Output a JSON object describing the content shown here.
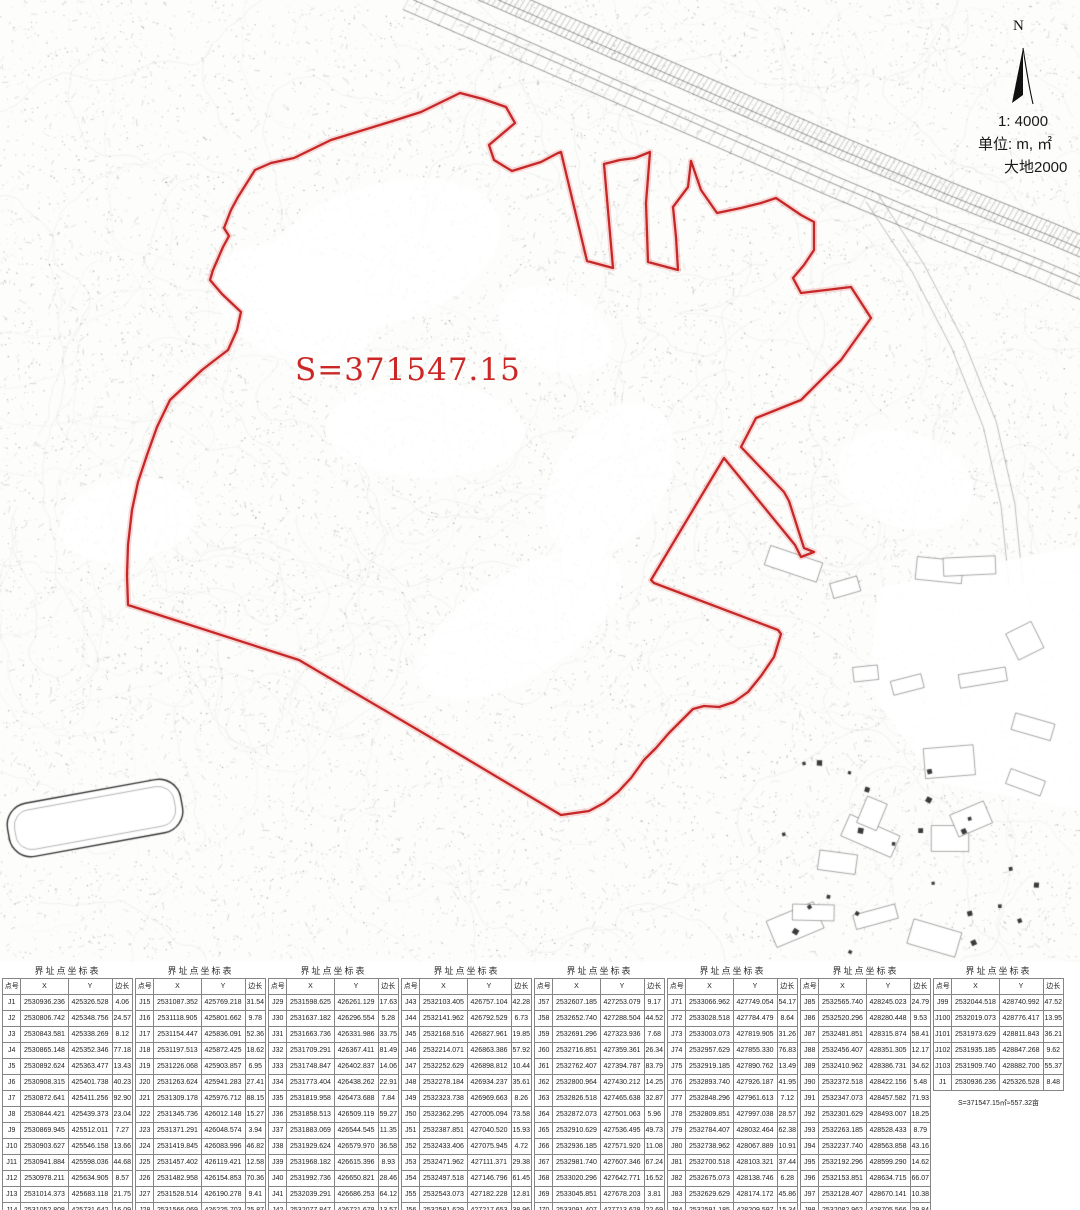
{
  "map": {
    "north_label": "N",
    "scale": "1: 4000",
    "units": "单位: m, ㎡",
    "datum": "大地2000",
    "area_label": "S=371547.15",
    "boundary_color": "#c62828"
  },
  "table": {
    "group_title": "界址点坐标表",
    "columns": [
      "点号",
      "X",
      "Y",
      "边长"
    ],
    "area_note": "S=371547.15㎡≈557.32亩",
    "groups": [
      {
        "rows": [
          [
            "J1",
            "2530936.236",
            "425326.528",
            "4.06"
          ],
          [
            "J2",
            "2530806.742",
            "425348.756",
            "24.57"
          ],
          [
            "J3",
            "2530843.581",
            "425338.269",
            "8.12"
          ],
          [
            "J4",
            "2530865.148",
            "425352.346",
            "77.18"
          ],
          [
            "J5",
            "2530892.624",
            "425363.477",
            "13.43"
          ],
          [
            "J6",
            "2530908.315",
            "425401.738",
            "40.23"
          ],
          [
            "J7",
            "2530872.641",
            "425411.256",
            "92.90"
          ],
          [
            "J8",
            "2530844.421",
            "425439.373",
            "23.04"
          ],
          [
            "J9",
            "2530869.945",
            "425512.011",
            "7.27"
          ],
          [
            "J10",
            "2530903.627",
            "425546.158",
            "13.66"
          ],
          [
            "J11",
            "2530941.884",
            "425598.036",
            "44.68"
          ],
          [
            "J12",
            "2530978.211",
            "425634.905",
            "8.57"
          ],
          [
            "J13",
            "2531014.373",
            "425683.118",
            "21.75"
          ],
          [
            "J14",
            "2531052.808",
            "425731.642",
            "16.09"
          ]
        ]
      },
      {
        "rows": [
          [
            "J15",
            "2531087.352",
            "425769.218",
            "31.54"
          ],
          [
            "J16",
            "2531118.905",
            "425801.662",
            "9.78"
          ],
          [
            "J17",
            "2531154.447",
            "425836.091",
            "52.36"
          ],
          [
            "J18",
            "2531197.513",
            "425872.425",
            "18.62"
          ],
          [
            "J19",
            "2531226.068",
            "425903.857",
            "6.95"
          ],
          [
            "J20",
            "2531263.624",
            "425941.283",
            "27.41"
          ],
          [
            "J21",
            "2531309.178",
            "425976.712",
            "88.15"
          ],
          [
            "J22",
            "2531345.736",
            "426012.148",
            "15.27"
          ],
          [
            "J23",
            "2531371.291",
            "426048.574",
            "3.94"
          ],
          [
            "J24",
            "2531419.845",
            "426083.996",
            "46.82"
          ],
          [
            "J25",
            "2531457.402",
            "426119.421",
            "12.58"
          ],
          [
            "J26",
            "2531482.958",
            "426154.853",
            "70.36"
          ],
          [
            "J27",
            "2531528.514",
            "426190.278",
            "9.41"
          ],
          [
            "J28",
            "2531566.069",
            "426225.703",
            "25.87"
          ]
        ]
      },
      {
        "rows": [
          [
            "J29",
            "2531598.625",
            "426261.129",
            "17.63"
          ],
          [
            "J30",
            "2531637.182",
            "426296.554",
            "5.28"
          ],
          [
            "J31",
            "2531663.736",
            "426331.986",
            "33.75"
          ],
          [
            "J32",
            "2531709.291",
            "426367.411",
            "81.49"
          ],
          [
            "J33",
            "2531748.847",
            "426402.837",
            "14.06"
          ],
          [
            "J34",
            "2531773.404",
            "426438.262",
            "22.91"
          ],
          [
            "J35",
            "2531819.958",
            "426473.688",
            "7.84"
          ],
          [
            "J36",
            "2531858.513",
            "426509.119",
            "59.27"
          ],
          [
            "J37",
            "2531883.069",
            "426544.545",
            "11.35"
          ],
          [
            "J38",
            "2531929.624",
            "426579.970",
            "36.58"
          ],
          [
            "J39",
            "2531968.182",
            "426615.396",
            "8.93"
          ],
          [
            "J40",
            "2531992.736",
            "426650.821",
            "28.46"
          ],
          [
            "J41",
            "2532039.291",
            "426686.253",
            "64.12"
          ],
          [
            "J42",
            "2532077.847",
            "426721.678",
            "13.57"
          ]
        ]
      },
      {
        "rows": [
          [
            "J43",
            "2532103.405",
            "426757.104",
            "42.28"
          ],
          [
            "J44",
            "2532141.962",
            "426792.529",
            "6.73"
          ],
          [
            "J45",
            "2532168.516",
            "426827.961",
            "19.85"
          ],
          [
            "J46",
            "2532214.071",
            "426863.386",
            "57.92"
          ],
          [
            "J47",
            "2532252.629",
            "426898.812",
            "10.44"
          ],
          [
            "J48",
            "2532278.184",
            "426934.237",
            "35.61"
          ],
          [
            "J49",
            "2532323.738",
            "426969.663",
            "8.26"
          ],
          [
            "J50",
            "2532362.295",
            "427005.094",
            "73.58"
          ],
          [
            "J51",
            "2532387.851",
            "427040.520",
            "15.93"
          ],
          [
            "J52",
            "2532433.406",
            "427075.945",
            "4.72"
          ],
          [
            "J53",
            "2532471.962",
            "427111.371",
            "29.38"
          ],
          [
            "J54",
            "2532497.518",
            "427146.796",
            "61.45"
          ],
          [
            "J55",
            "2532543.073",
            "427182.228",
            "12.81"
          ],
          [
            "J56",
            "2532581.629",
            "427217.653",
            "38.96"
          ]
        ]
      },
      {
        "rows": [
          [
            "J57",
            "2532607.185",
            "427253.079",
            "9.17"
          ],
          [
            "J58",
            "2532652.740",
            "427288.504",
            "44.52"
          ],
          [
            "J59",
            "2532691.296",
            "427323.936",
            "7.68"
          ],
          [
            "J60",
            "2532716.851",
            "427359.361",
            "26.34"
          ],
          [
            "J61",
            "2532762.407",
            "427394.787",
            "83.79"
          ],
          [
            "J62",
            "2532800.964",
            "427430.212",
            "14.25"
          ],
          [
            "J63",
            "2532826.518",
            "427465.638",
            "32.87"
          ],
          [
            "J64",
            "2532872.073",
            "427501.063",
            "5.96"
          ],
          [
            "J65",
            "2532910.629",
            "427536.495",
            "49.73"
          ],
          [
            "J66",
            "2532936.185",
            "427571.920",
            "11.08"
          ],
          [
            "J67",
            "2532981.740",
            "427607.346",
            "67.24"
          ],
          [
            "J68",
            "2533020.296",
            "427642.771",
            "16.52"
          ],
          [
            "J69",
            "2533045.851",
            "427678.203",
            "3.81"
          ],
          [
            "J70",
            "2533091.407",
            "427713.628",
            "22.69"
          ]
        ]
      },
      {
        "rows": [
          [
            "J71",
            "2533066.962",
            "427749.054",
            "54.17"
          ],
          [
            "J72",
            "2533028.518",
            "427784.479",
            "8.64"
          ],
          [
            "J73",
            "2533003.073",
            "427819.905",
            "31.26"
          ],
          [
            "J74",
            "2532957.629",
            "427855.330",
            "76.83"
          ],
          [
            "J75",
            "2532919.185",
            "427890.762",
            "13.49"
          ],
          [
            "J76",
            "2532893.740",
            "427926.187",
            "41.95"
          ],
          [
            "J77",
            "2532848.296",
            "427961.613",
            "7.12"
          ],
          [
            "J78",
            "2532809.851",
            "427997.038",
            "28.57"
          ],
          [
            "J79",
            "2532784.407",
            "428032.464",
            "62.38"
          ],
          [
            "J80",
            "2532738.962",
            "428067.889",
            "10.91"
          ],
          [
            "J81",
            "2532700.518",
            "428103.321",
            "37.44"
          ],
          [
            "J82",
            "2532675.073",
            "428138.746",
            "6.28"
          ],
          [
            "J83",
            "2532629.629",
            "428174.172",
            "45.86"
          ],
          [
            "J84",
            "2532591.185",
            "428209.597",
            "15.34"
          ]
        ]
      },
      {
        "rows": [
          [
            "J85",
            "2532565.740",
            "428245.023",
            "24.79"
          ],
          [
            "J86",
            "2532520.296",
            "428280.448",
            "9.53"
          ],
          [
            "J87",
            "2532481.851",
            "428315.874",
            "58.41"
          ],
          [
            "J88",
            "2532456.407",
            "428351.305",
            "12.17"
          ],
          [
            "J89",
            "2532410.962",
            "428386.731",
            "34.62"
          ],
          [
            "J90",
            "2532372.518",
            "428422.156",
            "5.48"
          ],
          [
            "J91",
            "2532347.073",
            "428457.582",
            "71.93"
          ],
          [
            "J92",
            "2532301.629",
            "428493.007",
            "18.25"
          ],
          [
            "J93",
            "2532263.185",
            "428528.433",
            "8.79"
          ],
          [
            "J94",
            "2532237.740",
            "428563.858",
            "43.16"
          ],
          [
            "J95",
            "2532192.296",
            "428599.290",
            "14.62"
          ],
          [
            "J96",
            "2532153.851",
            "428634.715",
            "66.07"
          ],
          [
            "J97",
            "2532128.407",
            "428670.141",
            "10.38"
          ],
          [
            "J98",
            "2532082.962",
            "428705.566",
            "29.84"
          ]
        ]
      },
      {
        "has_note": true,
        "rows": [
          [
            "J99",
            "2532044.518",
            "428740.992",
            "47.52"
          ],
          [
            "J100",
            "2532019.073",
            "428776.417",
            "13.95"
          ],
          [
            "J101",
            "2531973.629",
            "428811.843",
            "36.21"
          ],
          [
            "J102",
            "2531935.185",
            "428847.268",
            "9.62"
          ],
          [
            "J103",
            "2531909.740",
            "428882.700",
            "55.37"
          ],
          [
            "J1",
            "2530936.236",
            "425326.528",
            "8.48"
          ]
        ]
      }
    ]
  }
}
